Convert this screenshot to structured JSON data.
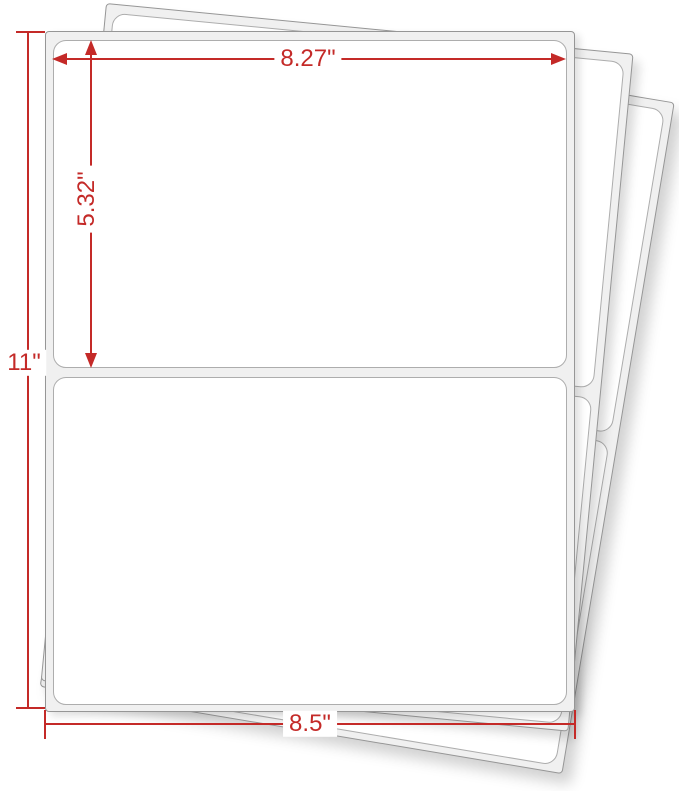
{
  "diagram": {
    "type": "label-sheet-dimension-diagram",
    "sheets_in_stack": 3,
    "labels_per_sheet": 2,
    "accent_color": "#c42a28",
    "sheet_fill_color": "#f0f0f0",
    "sheet_border_color": "#969696",
    "label_border_color": "#adadad",
    "dimensions": {
      "label_width": "8.27\"",
      "label_height": "5.32\"",
      "sheet_height": "11\"",
      "sheet_width": "8.5\""
    }
  }
}
